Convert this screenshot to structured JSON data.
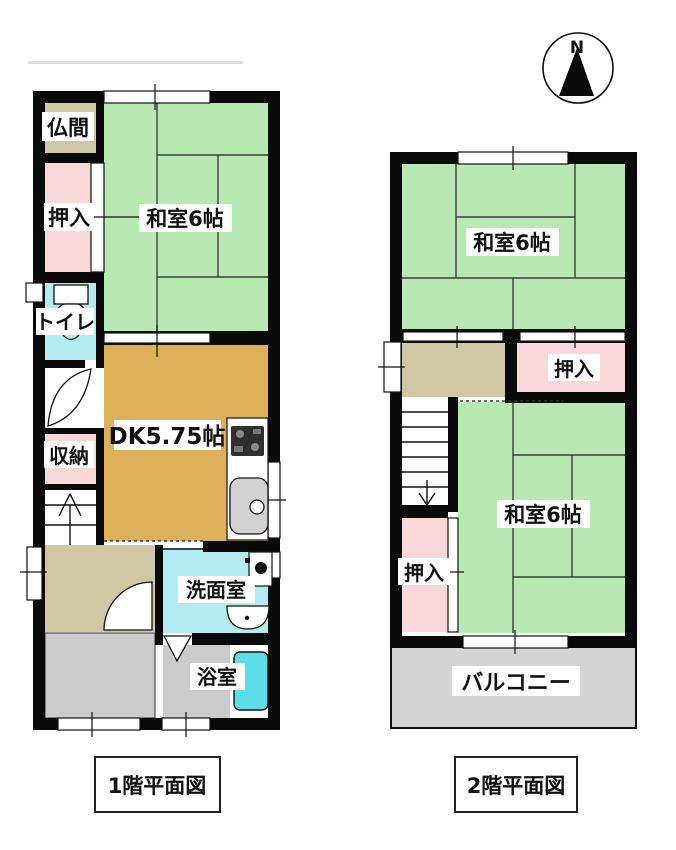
{
  "compass": {
    "north_label": "N"
  },
  "colors": {
    "wall": "#0a0a0a",
    "tatami_green": "#b9e9b2",
    "closet_pink": "#f9d8d9",
    "water_cyan": "#b3ebf1",
    "tub_cyan": "#5cdde8",
    "dk_tan": "#dcb15a",
    "hall_olive": "#d0c8a4",
    "floor_gray": "#cbcbcb",
    "balcony_gray": "#d4d4d4",
    "sink_gray": "#d2d2d2",
    "stove_dark": "#2f2f2f"
  },
  "floor1": {
    "caption": "1階平面図",
    "rooms": {
      "butsuma": {
        "label": "仏間"
      },
      "oshiire": {
        "label": "押入"
      },
      "toilet": {
        "label": "トイレ"
      },
      "washitsu": {
        "label": "和室6帖"
      },
      "dk": {
        "label": "DK5.75帖"
      },
      "shuno": {
        "label": "収納"
      },
      "senmenshitsu": {
        "label": "洗面室"
      },
      "yokushitsu": {
        "label": "浴室"
      }
    }
  },
  "floor2": {
    "caption": "2階平面図",
    "rooms": {
      "washitsu_north": {
        "label": "和室6帖"
      },
      "oshiire_north": {
        "label": "押入"
      },
      "oshiire_south": {
        "label": "押入"
      },
      "washitsu_south": {
        "label": "和室6帖"
      },
      "balcony": {
        "label": "バルコニー"
      }
    }
  }
}
